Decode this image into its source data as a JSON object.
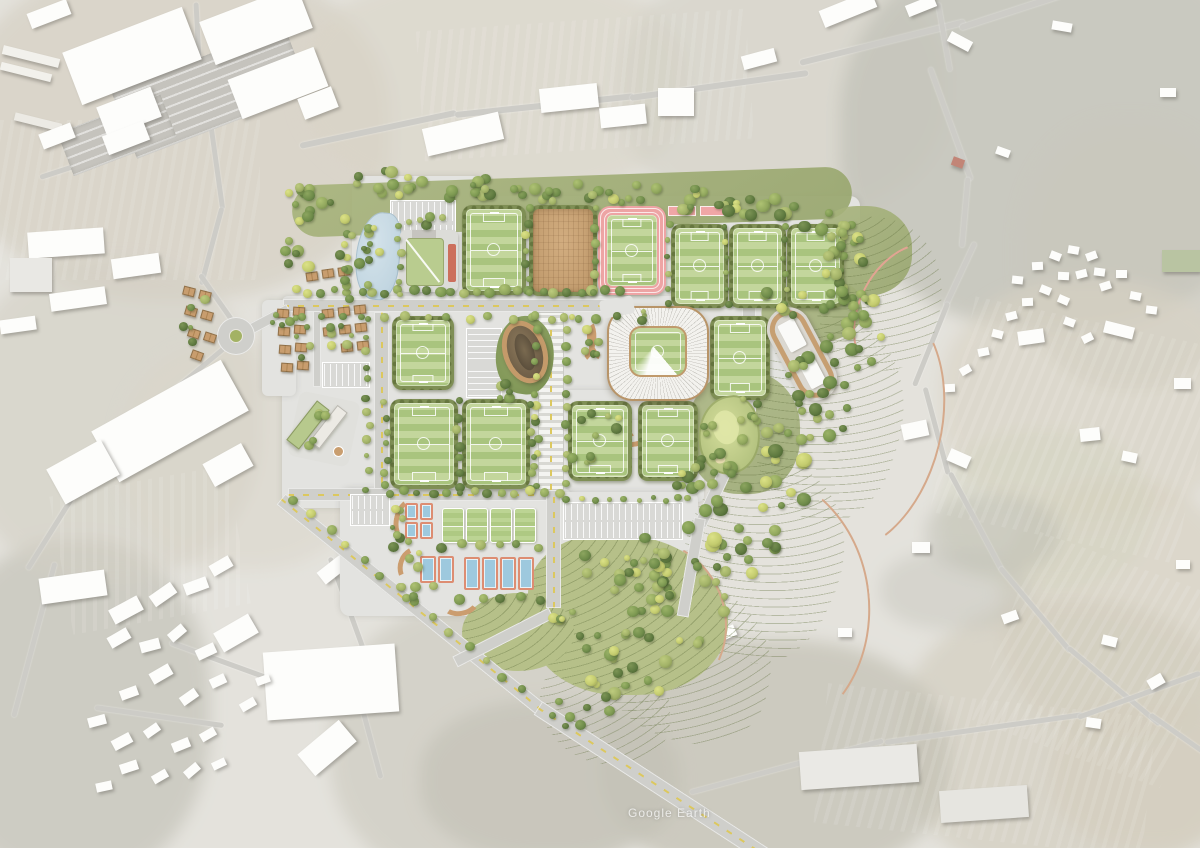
{
  "scene": {
    "watermark": "Google Earth"
  },
  "palette": {
    "background_wash": "#d6d3cc",
    "hardscape": "#e3e3e0",
    "road_gray": "#cfcfcb",
    "road_marking_yellow": "#dcc85e",
    "pitch_green_light": "#c3d69c",
    "pitch_green_dark": "#a9c47e",
    "hedge_olive": "#7f8f55",
    "forest_olive": "#91a069",
    "terrace_lawn": "#b6c089",
    "track_pink": "#eda4a4",
    "clay_brown": "#c9a277",
    "stadium_bronze": "#c09a6c",
    "stand_white": "#f3f2ee",
    "pond_blue": "#c6d9e3",
    "court_blue": "#9ec9de",
    "court_trim_red": "#dd8d72",
    "cabin_roof_tan": "#c89d6e",
    "trail_tan": "#d5a98b"
  },
  "facilities": [
    {
      "id": "stadium",
      "label": "Main stadium",
      "count": 1
    },
    {
      "id": "training-pitch",
      "label": "Training pitches",
      "count": 10
    },
    {
      "id": "athletics-track-pitch",
      "label": "Pitch with athletics track",
      "count": 1
    },
    {
      "id": "covered-pitch",
      "label": "Covered clay pitch",
      "count": 1
    },
    {
      "id": "mini-pitch",
      "label": "Mini pitches",
      "count": 4
    },
    {
      "id": "court",
      "label": "Tennis and padel courts",
      "count": 10
    },
    {
      "id": "putting-green",
      "label": "Putting green",
      "count": 1
    },
    {
      "id": "oval-pavilion",
      "label": "Oval pavilion",
      "count": 1
    },
    {
      "id": "residence",
      "label": "Residence building",
      "count": 1
    },
    {
      "id": "entrance-pavilion",
      "label": "Entrance pavilion",
      "count": 1
    },
    {
      "id": "clubhouse",
      "label": "Clubhouse",
      "count": 1
    },
    {
      "id": "cabin",
      "label": "Lodge cabins",
      "count": 26
    },
    {
      "id": "pond",
      "label": "Pond",
      "count": 1
    },
    {
      "id": "parking",
      "label": "Parking lots",
      "count": 6
    },
    {
      "id": "roundabout",
      "label": "Roundabout",
      "count": 1
    },
    {
      "id": "hillside-park",
      "label": "Hillside park with trails",
      "count": 1
    },
    {
      "id": "terraced-garden",
      "label": "Terraced gardens",
      "count": 2
    }
  ]
}
